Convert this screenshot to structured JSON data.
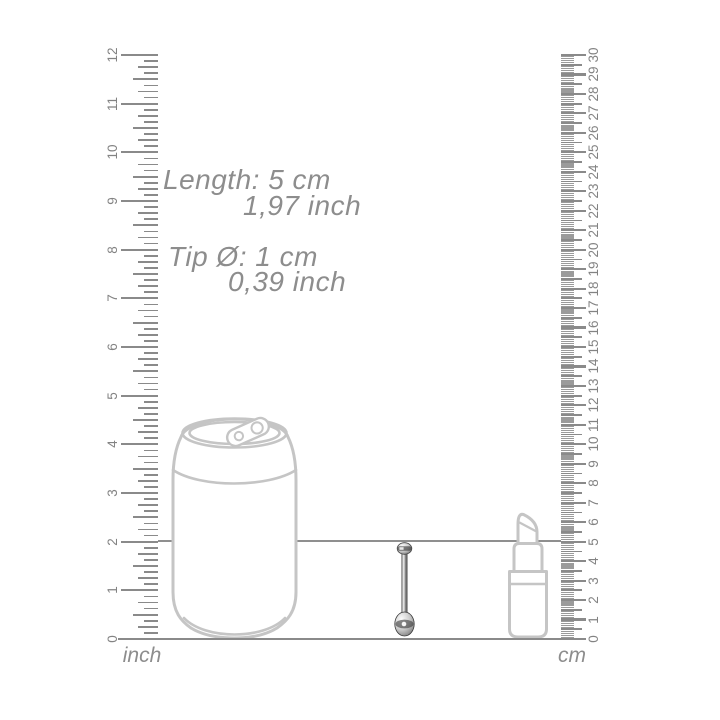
{
  "measurements": {
    "length_line1": "Length: 5 cm",
    "length_line2": "1,97 inch",
    "tip_line1": "Tip Ø: 1 cm",
    "tip_line2": "0,39 inch"
  },
  "rulers": {
    "inch": {
      "unit_label": "inch",
      "min": 0,
      "max": 12,
      "subdivisions_per_unit": 8,
      "tick_labels": [
        0,
        1,
        2,
        3,
        4,
        5,
        6,
        7,
        8,
        9,
        10,
        11,
        12
      ]
    },
    "cm": {
      "unit_label": "cm",
      "min": 0,
      "max": 30,
      "subdivisions_per_unit": 10,
      "tick_labels": [
        0,
        1,
        2,
        3,
        4,
        5,
        6,
        7,
        8,
        9,
        10,
        11,
        12,
        13,
        14,
        15,
        16,
        17,
        18,
        19,
        20,
        21,
        22,
        23,
        24,
        25,
        26,
        27,
        28,
        29,
        30
      ]
    }
  },
  "guide_line_values": {
    "inch_mark": 2,
    "cm_mark": 5
  },
  "reference_objects": [
    {
      "name": "soda-can"
    },
    {
      "name": "piercing-barbell-product"
    },
    {
      "name": "lipstick"
    }
  ],
  "colors": {
    "background": "#ffffff",
    "ruler_tick": "#8a8a8a",
    "mm_tick": "#9b9b9b",
    "annotation_text": "#8d8d8d",
    "outline_drawing": "#c5c5c5",
    "guide_line": "#8f8f8f"
  }
}
